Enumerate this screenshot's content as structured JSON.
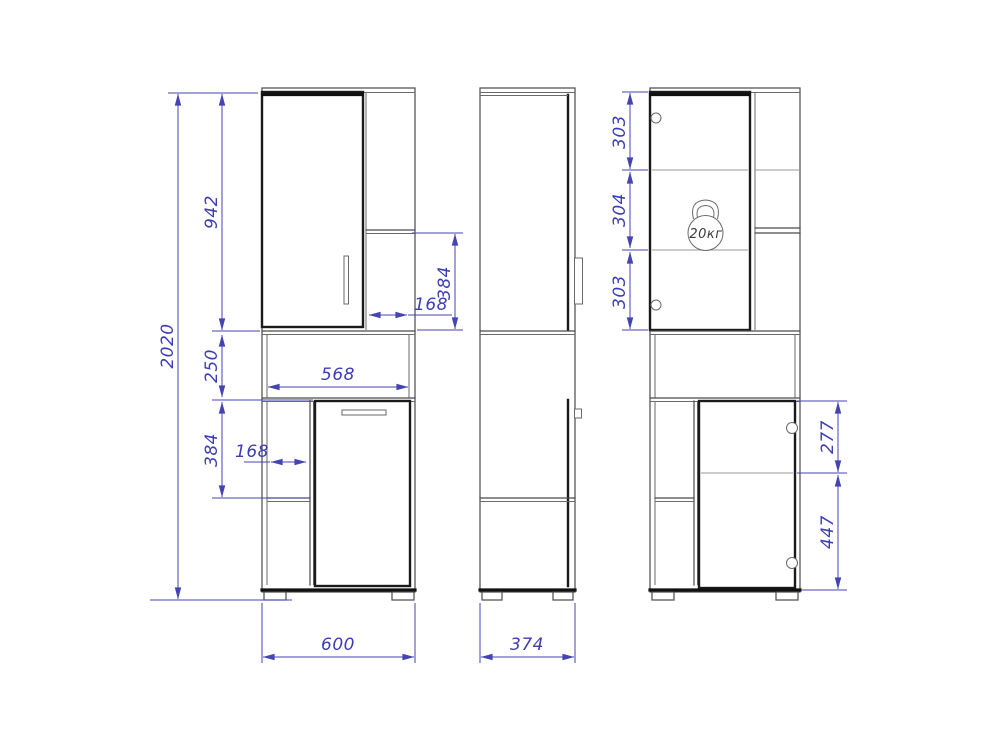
{
  "title": "Cabinet technical drawing, three views with dimensions",
  "views": {
    "front": {
      "dims": {
        "overall_height": "2020",
        "upper_cabinet_height": "942",
        "middle_niche_height": "250",
        "lower_niche_height": "384",
        "lower_niche_width": "168",
        "inner_width": "568",
        "upper_niche_height": "384",
        "upper_niche_width": "168",
        "overall_width": "600"
      }
    },
    "side": {
      "dims": {
        "depth": "374"
      }
    },
    "interior": {
      "dims": {
        "top_shelf_height": "303",
        "middle_shelf_height": "304",
        "bottom_shelf_height": "303",
        "upper_door_section": "277",
        "lower_door_section": "447"
      },
      "max_load_badge": "20кг"
    }
  },
  "colors": {
    "background": "#ffffff",
    "outline": "#4a4a4a",
    "door_outline": "#1a1a1a",
    "shelf_line": "#989898",
    "dimension": "#4444b2"
  }
}
